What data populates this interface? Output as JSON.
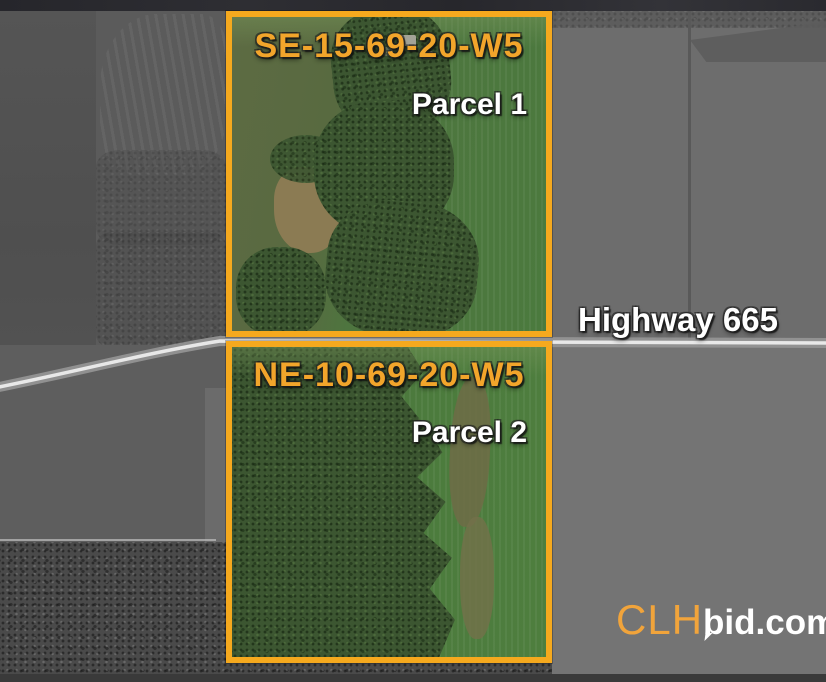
{
  "map": {
    "highway": {
      "label": "Highway 665"
    },
    "parcels": [
      {
        "id": "SE-15-69-20-W5",
        "name": "Parcel 1"
      },
      {
        "id": "NE-10-69-20-W5",
        "name": "Parcel 2"
      }
    ],
    "colors": {
      "parcel_border": "#F5A91E",
      "parcel_id_text": "#F2A52B",
      "annotation_text": "#FFFFFF",
      "parcel_field_green": "#4E7A3E",
      "parcel_forest_green": "#3C5631"
    }
  },
  "branding": {
    "logo": {
      "prefix": "CLH",
      "suffix": "bid.com",
      "prefix_color": "#F1A43B",
      "suffix_color": "#FFFFFF"
    }
  }
}
